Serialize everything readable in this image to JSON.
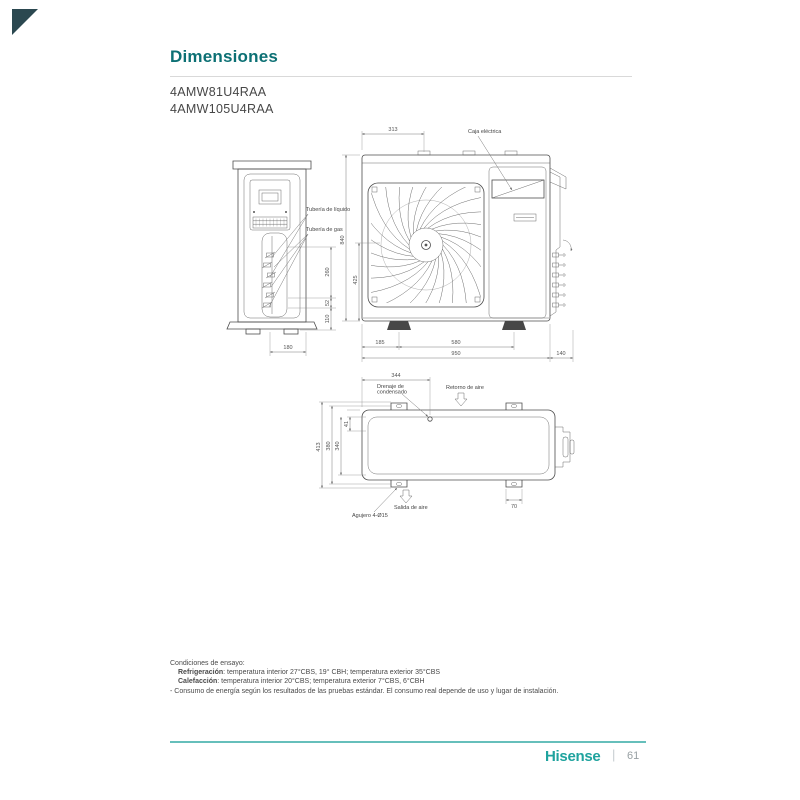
{
  "page": {
    "title": "Dimensiones",
    "models": [
      "4AMW81U4RAA",
      "4AMW105U4RAA"
    ]
  },
  "drawing": {
    "labels": {
      "tuberia_liquido": "Tubería de líquido",
      "tuberia_gas": "Tubería de gas",
      "caja_electrica": "Caja eléctrica",
      "drenaje_line1": "Drenaje de",
      "drenaje_line2": "condensado",
      "retorno_aire": "Retorno de aire",
      "salida_aire": "Salida de aire",
      "agujero": "Agujero 4-Ø15"
    },
    "front_dims": {
      "top_width": "313",
      "height": "840",
      "fan_center": "425",
      "foot_offset": "185",
      "feet_span": "580",
      "total_width": "950",
      "side_depth": "140"
    },
    "side_dims": {
      "pipe_1": "260",
      "pipe_2": "52",
      "pipe_3": "110",
      "base_width": "180"
    },
    "top_dims": {
      "drain_offset": "344",
      "overall_depth": "413",
      "feet_depth": "380",
      "body_depth": "340",
      "edge_offset": "41",
      "foot_width": "70"
    }
  },
  "conditions": {
    "heading": "Condiciones de ensayo:",
    "refrigeracion_label": "Refrigeración",
    "refrigeracion_text": ": temperatura interior 27°CBS, 19° CBH; temperatura exterior 35°CBS",
    "calefaccion_label": "Calefacción",
    "calefaccion_text": ": temperatura interior 20°CBS; temperatura exterior 7°CBS, 6°CBH",
    "consumo": "- Consumo de energía según los resultados de las pruebas estándar. El consumo real depende de uso y lugar de instalación."
  },
  "footer": {
    "brand": "Hisense",
    "separator": "|",
    "page_number": "61"
  },
  "colors": {
    "teal": "#1FA39E",
    "title_teal": "#0C7074",
    "rule_teal": "#66BFBB",
    "triangle": "#2B4850",
    "line_gray": "#4D4D4D"
  }
}
